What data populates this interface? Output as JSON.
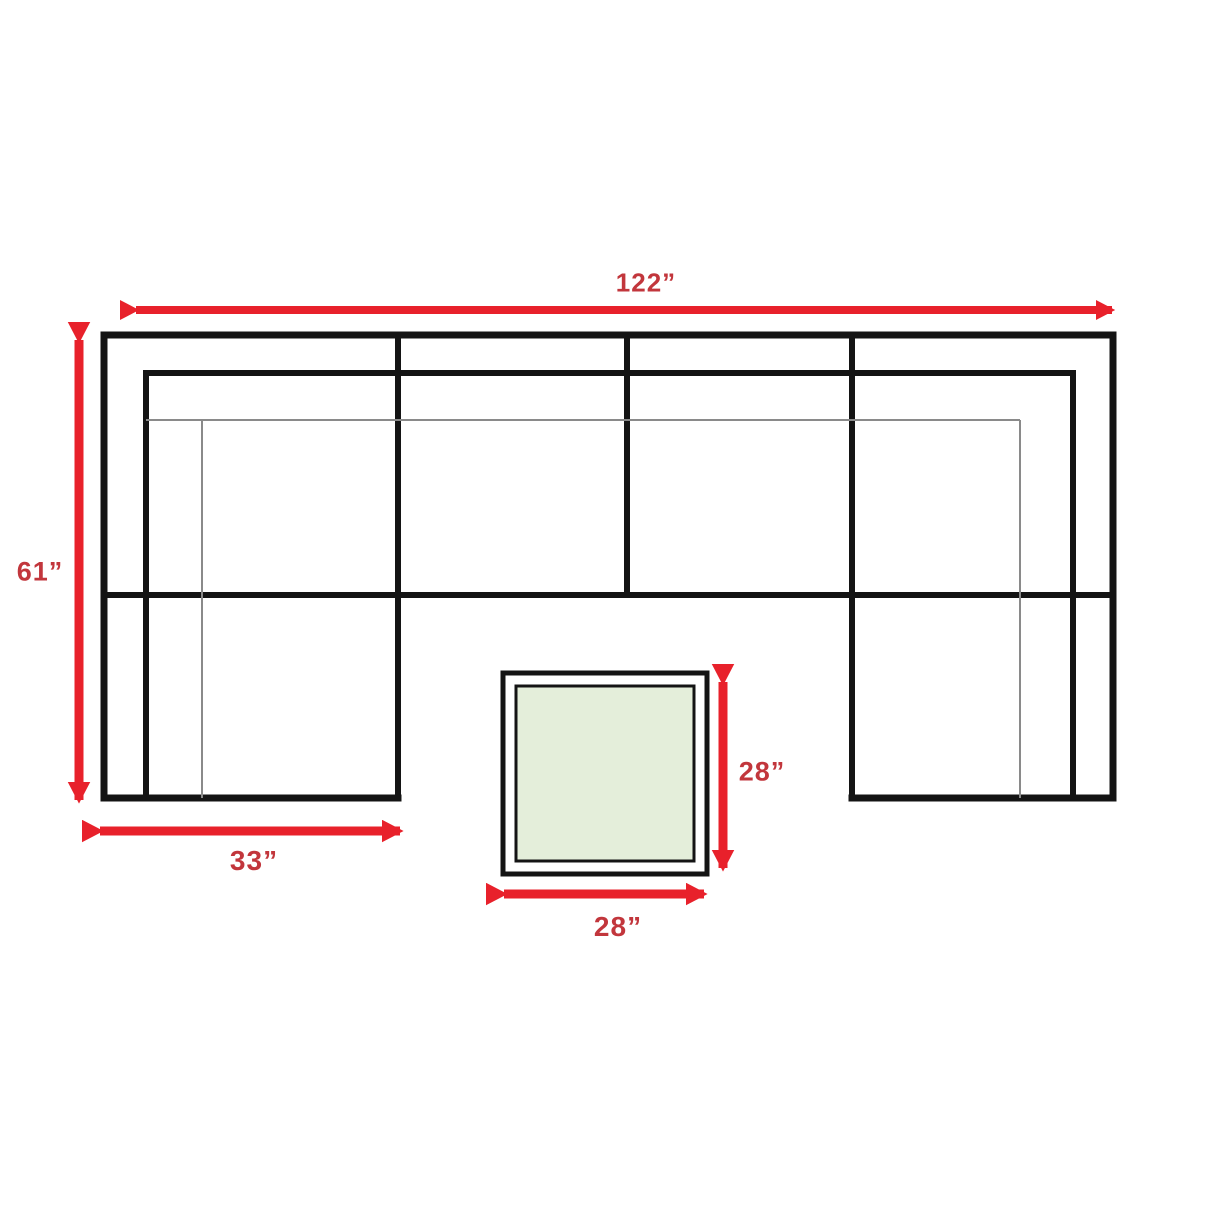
{
  "diagram": {
    "type": "furniture-dimension-floorplan",
    "subject": "u-shaped-sectional-sofa-with-square-ottoman-table",
    "unit": "inches",
    "dimensions": {
      "overall_width": "122”",
      "overall_depth": "61”",
      "left_chaise_width": "33”",
      "table_depth": "28”",
      "table_width": "28”"
    },
    "colors": {
      "arrow": "#e8212b",
      "label": "#c2363c",
      "outline": "#141414",
      "thin_line": "#8a8a8a",
      "table_fill": "#e4eeda",
      "background": "#ffffff"
    }
  }
}
